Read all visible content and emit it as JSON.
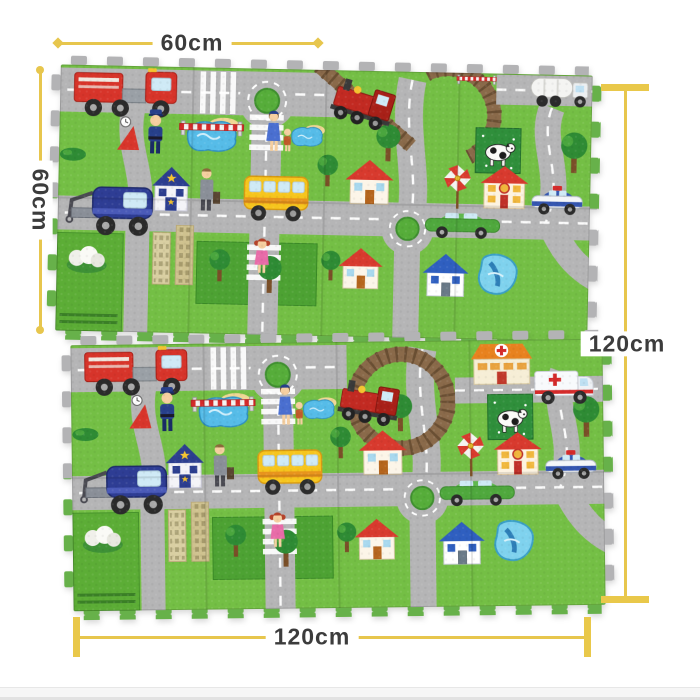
{
  "annotations": {
    "top": {
      "label": "60cm",
      "orientation": "horizontal"
    },
    "left": {
      "label": "60cm",
      "orientation": "vertical"
    },
    "right": {
      "label": "120cm",
      "orientation": "vertical"
    },
    "bottom": {
      "label": "120cm",
      "orientation": "horizontal"
    }
  },
  "palette": {
    "dimension_line": "#e7c64d",
    "dimension_text": "#3c3c3c",
    "background": "#ffffff",
    "mat_road": "#b5b5b6",
    "mat_grass": "#74bf45",
    "mat_grass_dark": "#4da233",
    "water_blue": "#56bce8",
    "rail_brown": "#8a6a4a",
    "fire_truck_red": "#d7342a",
    "bus_yellow": "#f6c51d",
    "tow_truck_blue": "#2e3d94",
    "hospital_roof_orange": "#e8821f",
    "police_roof_navy": "#2c3e8f"
  },
  "mats": {
    "top_mat": {
      "elements": [
        "fire-truck",
        "police-officer",
        "crosswalk",
        "roundabout",
        "pond",
        "railroad-barrier",
        "police-station",
        "traveler",
        "school-bus",
        "crossing-lady",
        "tow-truck",
        "skyscrapers",
        "park",
        "flower-bush",
        "girl-crossing",
        "red-roof-house",
        "windmill",
        "star-house",
        "cow-field",
        "steam-train",
        "railway-bridge",
        "tanker-truck",
        "green-car",
        "police-car",
        "blue-roof-house",
        "swimming-pool",
        "trees"
      ]
    },
    "bottom_mat": {
      "elements": [
        "fire-truck",
        "police-officer",
        "crosswalk",
        "roundabout",
        "pond",
        "railroad-barrier",
        "police-station",
        "traveler",
        "school-bus",
        "crossing-lady",
        "tow-truck",
        "skyscrapers",
        "park",
        "flower-bush",
        "girl-crossing",
        "red-roof-house",
        "windmill",
        "star-house",
        "cow-field",
        "steam-train",
        "railway-loop",
        "hospital",
        "ambulance",
        "green-car",
        "police-car",
        "blue-roof-house",
        "swimming-pool",
        "trees"
      ]
    }
  }
}
